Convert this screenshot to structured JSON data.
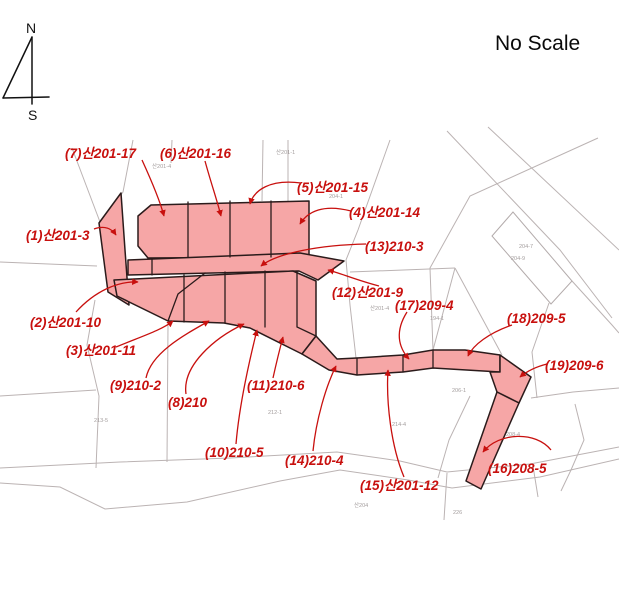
{
  "header": {
    "scale_label": "No Scale"
  },
  "compass": {
    "north": "N",
    "south": "S"
  },
  "colors": {
    "parcel_fill": "#F6A6A6",
    "parcel_stroke": "#2B1B1B",
    "label_red": "#C8100E",
    "background_line": "#BBB3B3",
    "tiny_label": "#A39D9D",
    "text": "#111111"
  },
  "parcel_labels": [
    {
      "id": 1,
      "text": "(1)산201-3"
    },
    {
      "id": 2,
      "text": "(2)산201-10"
    },
    {
      "id": 3,
      "text": "(3)산201-11"
    },
    {
      "id": 4,
      "text": "(4)산201-14"
    },
    {
      "id": 5,
      "text": "(5)산201-15"
    },
    {
      "id": 6,
      "text": "(6)산201-16"
    },
    {
      "id": 7,
      "text": "(7)산201-17"
    },
    {
      "id": 8,
      "text": "(8)210"
    },
    {
      "id": 9,
      "text": "(9)210-2"
    },
    {
      "id": 10,
      "text": "(10)210-5"
    },
    {
      "id": 11,
      "text": "(11)210-6"
    },
    {
      "id": 12,
      "text": "(12)산201-9"
    },
    {
      "id": 13,
      "text": "(13)210-3"
    },
    {
      "id": 14,
      "text": "(14)210-4"
    },
    {
      "id": 15,
      "text": "(15)산201-12"
    },
    {
      "id": 16,
      "text": "(16)208-5"
    },
    {
      "id": 17,
      "text": "(17)209-4"
    },
    {
      "id": 18,
      "text": "(18)209-5"
    },
    {
      "id": 19,
      "text": "(19)209-6"
    }
  ],
  "background_labels": [
    {
      "text": "산201-4"
    },
    {
      "text": "산201-1"
    },
    {
      "text": "204-1"
    },
    {
      "text": "204-7"
    },
    {
      "text": "204-9"
    },
    {
      "text": "산201-4"
    },
    {
      "text": "194-1"
    },
    {
      "text": "206-1"
    },
    {
      "text": "208-4"
    },
    {
      "text": "214-4"
    },
    {
      "text": "213-5"
    },
    {
      "text": "212-1"
    },
    {
      "text": "226"
    },
    {
      "text": "산204"
    }
  ]
}
